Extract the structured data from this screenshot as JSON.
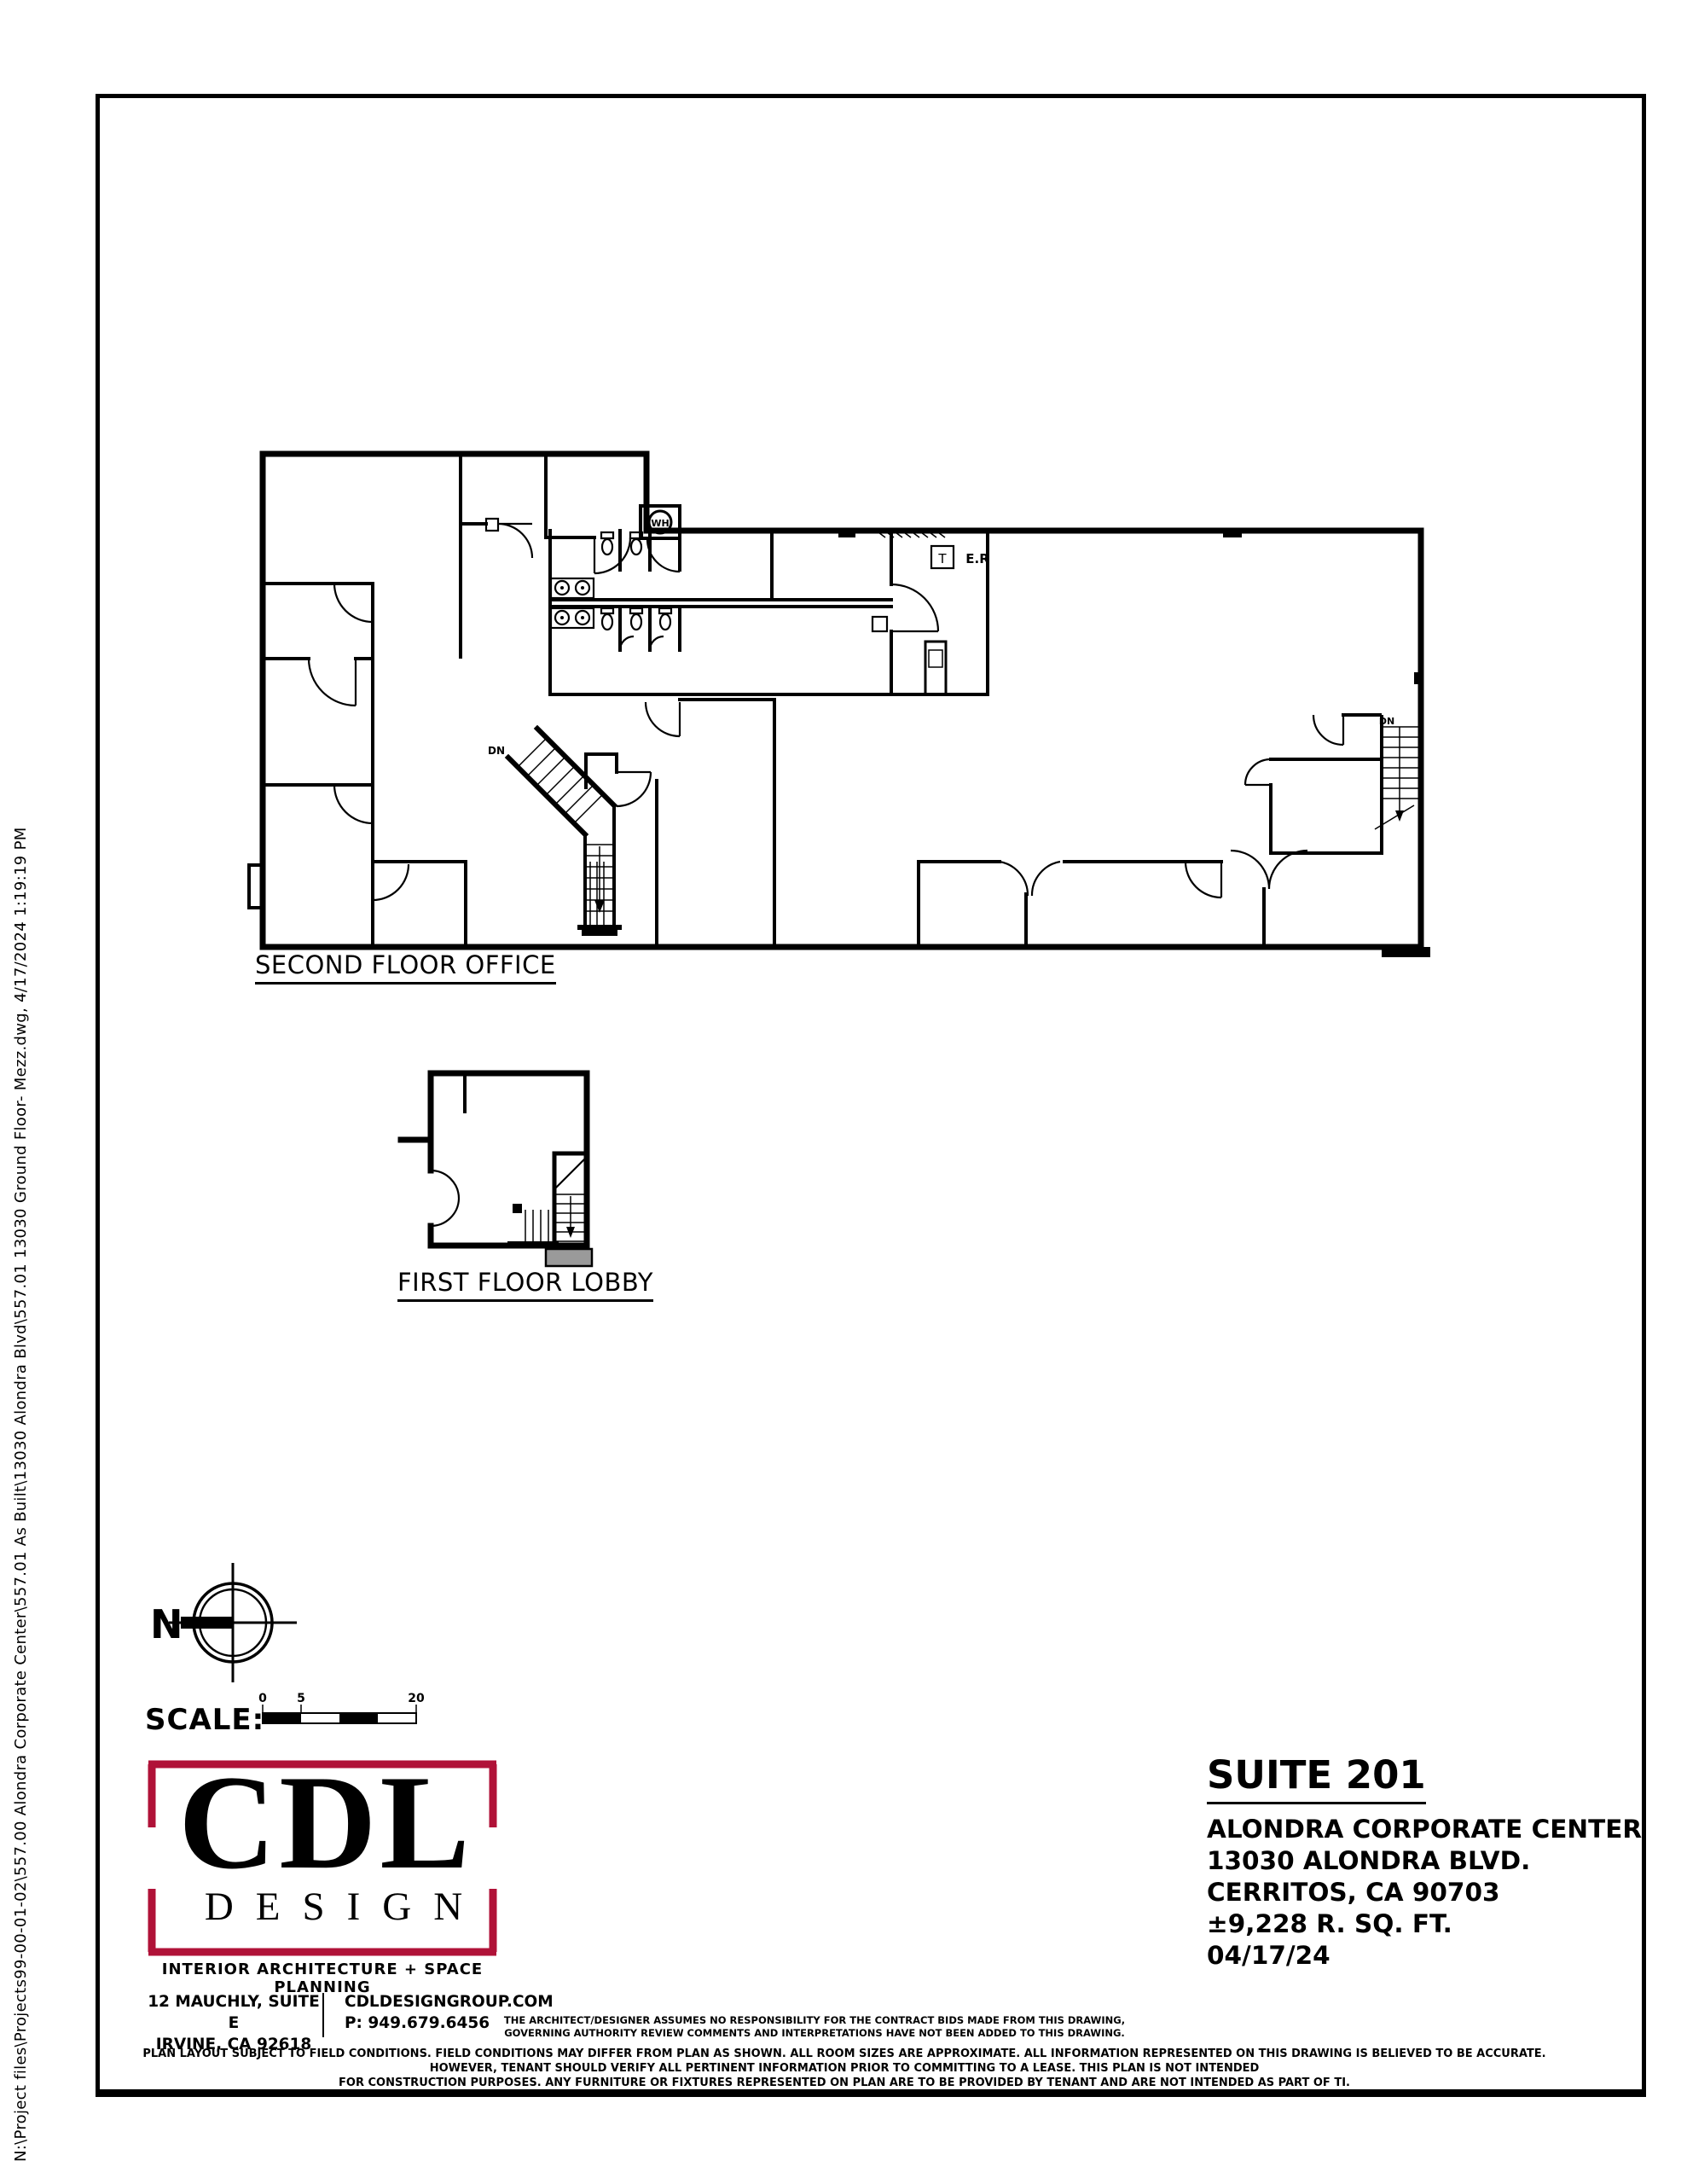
{
  "sheet": {
    "file_path_note": "N:\\Project files\\Projects99-00-01-02\\557.00 Alondra Corporate Center\\557.01 As Built\\13030 Alondra Blvd\\557.01 13030 Ground Floor- Mezz.dwg, 4/17/2024 1:19:19 PM"
  },
  "plans": {
    "second_floor_label": "SECOND FLOOR OFFICE",
    "first_floor_label": "FIRST FLOOR LOBBY",
    "annotations": {
      "water_heater": "WH",
      "thermostat": "T",
      "electrical_room": "E.R",
      "stair_down_1": "DN",
      "stair_down_2": "DN"
    }
  },
  "compass": {
    "north_label": "N"
  },
  "scale_bar": {
    "label": "SCALE:",
    "ticks": [
      "0",
      "5",
      "20"
    ]
  },
  "logo": {
    "line1": "CDL",
    "line2": "DESIGN",
    "tagline": "INTERIOR ARCHITECTURE + SPACE PLANNING",
    "address_line1": "12 MAUCHLY, SUITE  E",
    "address_line2": "IRVINE, CA 92618",
    "website": "CDLDESIGNGROUP.COM",
    "phone": "P: 949.679.6456",
    "accent_color": "#b01238"
  },
  "title_block": {
    "suite": "SUITE 201",
    "building": "ALONDRA CORPORATE CENTER",
    "street": "13030 ALONDRA BLVD.",
    "city": "CERRITOS, CA 90703",
    "area": "±9,228 R. SQ. FT.",
    "date": "04/17/24"
  },
  "disclaimers": {
    "architect_line1": "THE ARCHITECT/DESIGNER ASSUMES NO RESPONSIBILITY FOR THE CONTRACT BIDS MADE FROM THIS DRAWING,",
    "architect_line2": "GOVERNING AUTHORITY REVIEW COMMENTS AND INTERPRETATIONS HAVE NOT BEEN ADDED TO THIS DRAWING.",
    "plan_line1": "PLAN LAYOUT SUBJECT TO FIELD CONDITIONS. FIELD CONDITIONS MAY DIFFER FROM PLAN AS SHOWN. ALL ROOM SIZES ARE APPROXIMATE. ALL INFORMATION REPRESENTED ON THIS DRAWING IS BELIEVED TO BE ACCURATE.  HOWEVER, TENANT SHOULD VERIFY ALL PERTINENT INFORMATION PRIOR TO COMMITTING TO A LEASE. THIS PLAN IS NOT INTENDED",
    "plan_line2": "FOR CONSTRUCTION PURPOSES. ANY FURNITURE OR FIXTURES REPRESENTED ON PLAN ARE TO BE PROVIDED BY TENANT AND ARE NOT INTENDED AS PART OF TI."
  }
}
